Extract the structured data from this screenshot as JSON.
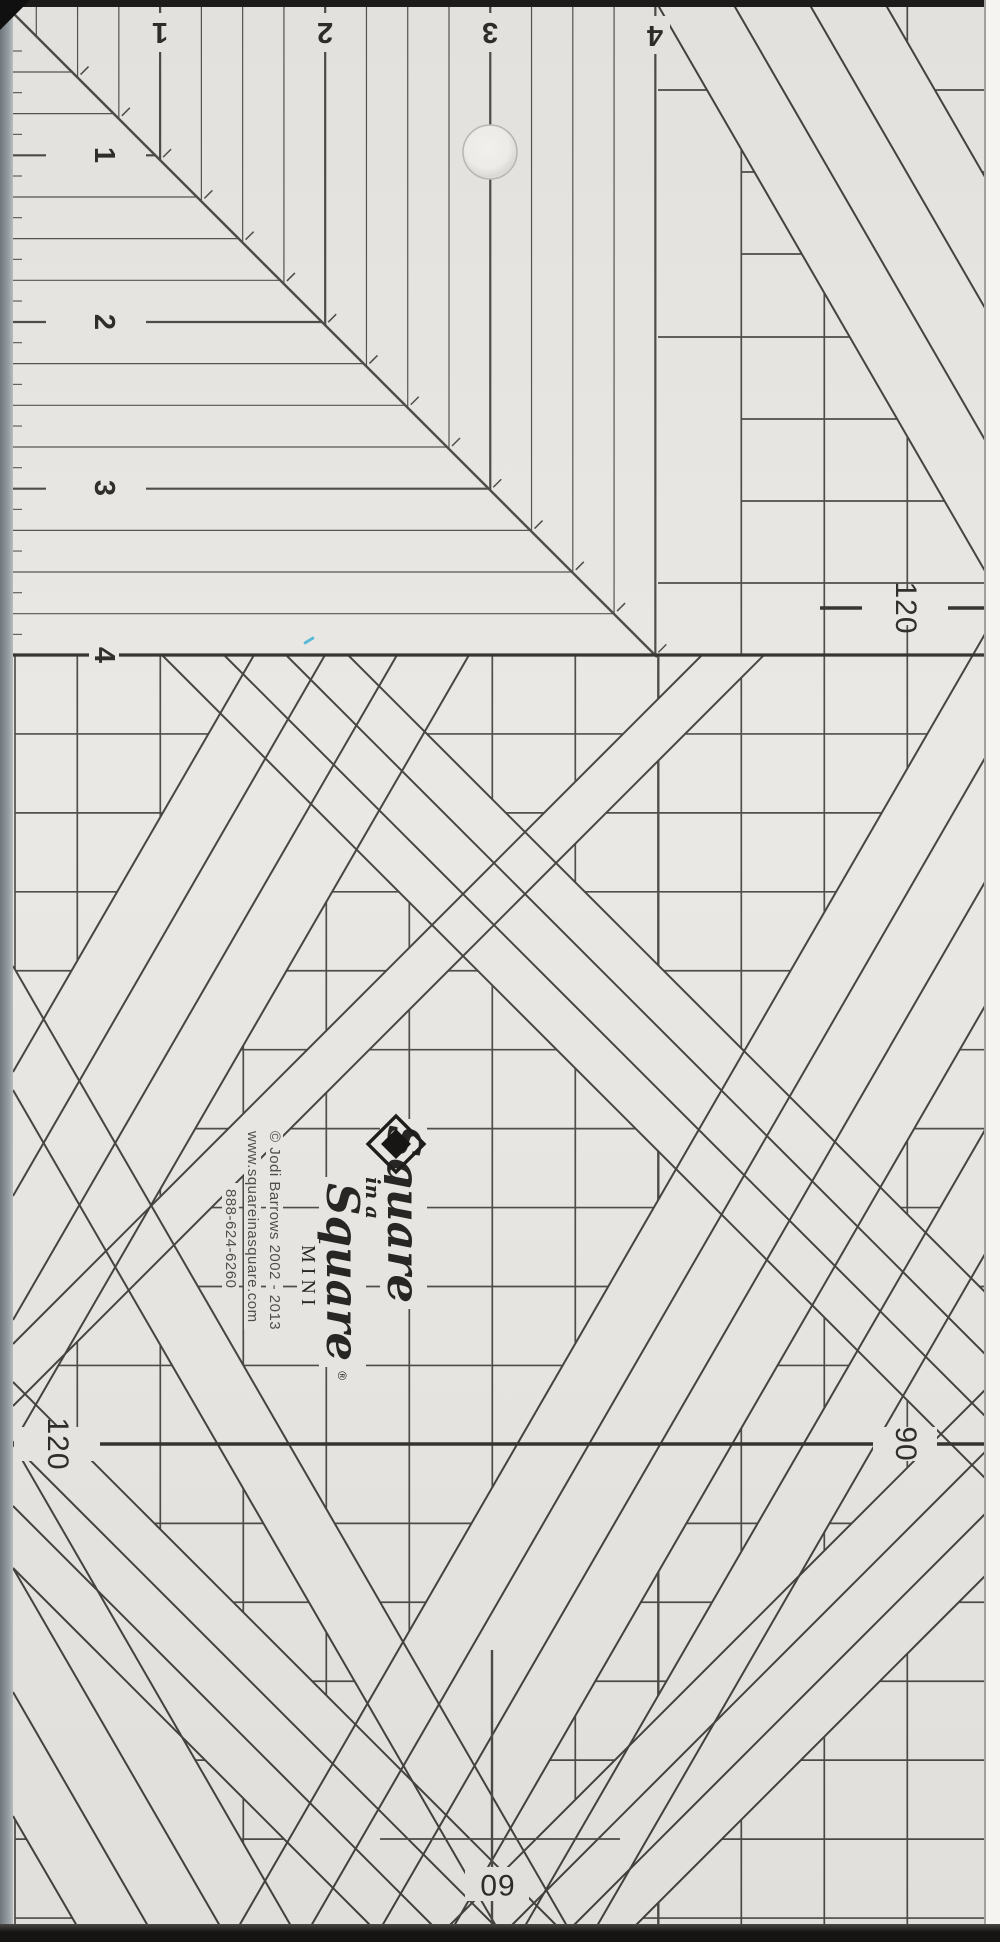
{
  "ruler": {
    "product": {
      "brand_line1": "Square",
      "brand_line2": "in a",
      "brand_line3": "Square",
      "registered_mark": "®",
      "model": "MINI",
      "copyright": "© Jodi Barrows  2002 - 2013",
      "website": "www.squareinasquare.com",
      "phone": "888-624-6260"
    },
    "top_scale": {
      "unit_labels": [
        "1",
        "2",
        "3",
        "4"
      ]
    },
    "left_scale": {
      "unit_labels": [
        "1",
        "2",
        "3",
        "4"
      ]
    },
    "angle_markers": {
      "right_upper": "120",
      "left_lower": "120",
      "right_lower": "90",
      "bottom_center": "60"
    },
    "icons": {
      "logo": "diamond-logo",
      "hole": "hanging-hole"
    },
    "colors": {
      "body": "#eae8e4",
      "grid_line": "#4e4c49",
      "dark_line": "#35332f",
      "text": "#2f2d2a",
      "edge_bevel": "#8a9196",
      "scan_edge": "#1d1c1a"
    }
  }
}
